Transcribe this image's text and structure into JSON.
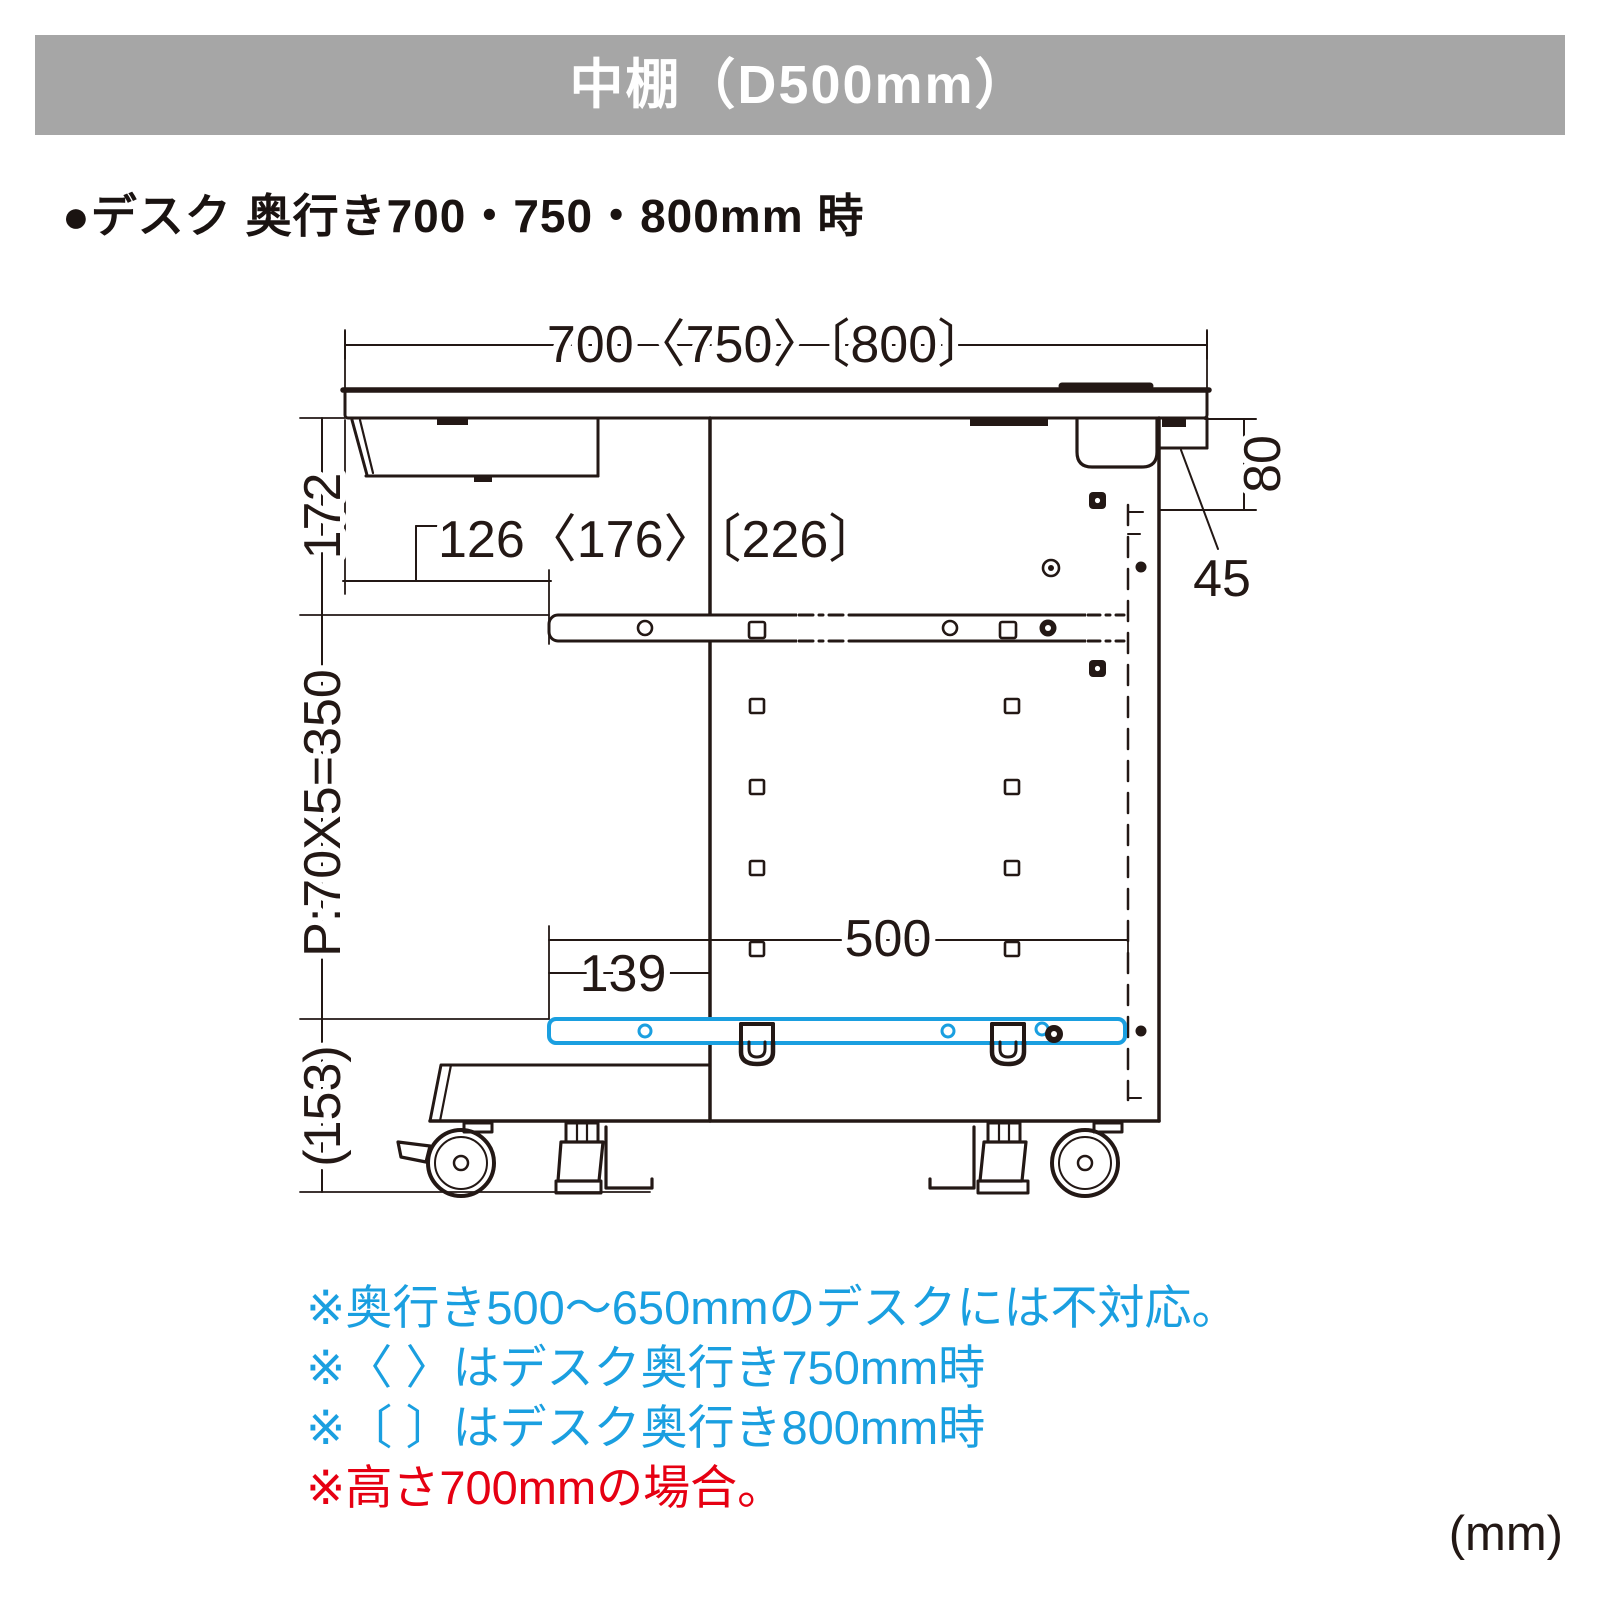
{
  "header": {
    "title": "中棚（D500mm）",
    "bg_color": "#a6a6a6"
  },
  "subtitle": "●デスク 奥行き700・750・800mm 時",
  "diagram": {
    "dimensions": {
      "desk_depth": "700〈750〉〔800〕",
      "tray_setback": "126〈176〉〔226〕",
      "top_to_rail": "172",
      "hole_pitch": "P:70X5=350",
      "caster_height": "(153)",
      "shelf_depth": "500",
      "shelf_front_offset": "139",
      "rail_drop": "80",
      "rear_offset": "45"
    }
  },
  "notes": [
    {
      "text": "※奥行き500〜650mmのデスクには不対応。",
      "color": "#1a9fe0"
    },
    {
      "text": "※〈 〉はデスク奥行き750mm時",
      "color": "#1a9fe0"
    },
    {
      "text": "※〔 〕はデスク奥行き800mm時",
      "color": "#1a9fe0"
    },
    {
      "text": "※高さ700mmの場合。",
      "color": "#e60012"
    }
  ],
  "unit_label": "(mm)",
  "colors": {
    "header_bg": "#a6a6a6",
    "accent_blue": "#1a9fe0",
    "note_red": "#e60012",
    "line_color": "#231815"
  }
}
